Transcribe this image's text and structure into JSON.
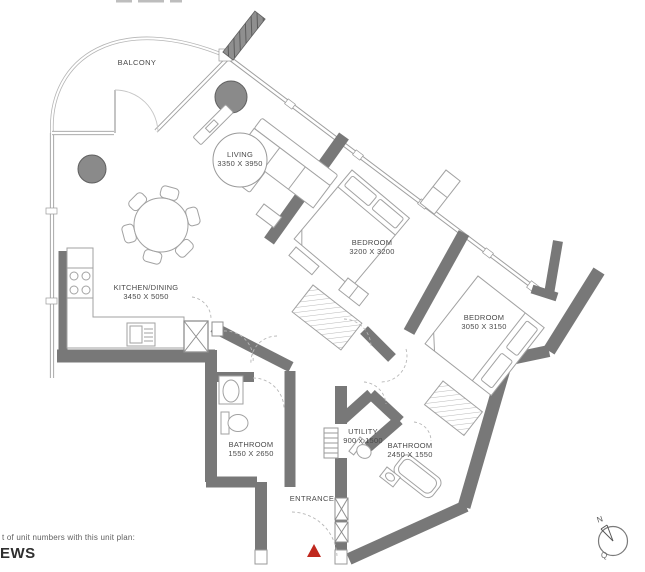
{
  "plan": {
    "rooms": {
      "balcony": {
        "label": "BALCONY"
      },
      "living": {
        "label": "LIVING",
        "dims": "3350 X 3950"
      },
      "kitchen_dining": {
        "label": "KITCHEN/DINING",
        "dims": "3450 X 5050"
      },
      "bedroom_1": {
        "label": "BEDROOM",
        "dims": "3200 X 3200"
      },
      "bedroom_2": {
        "label": "BEDROOM",
        "dims": "3050 X 3150"
      },
      "bathroom_1": {
        "label": "BATHROOM",
        "dims": "1550 X 2650"
      },
      "bathroom_2": {
        "label": "BATHROOM",
        "dims": "2450 X 1550"
      },
      "utility": {
        "label": "UTILITY",
        "dims": "900 x 1500"
      },
      "entrance": {
        "label": "ENTRANCE"
      }
    },
    "compass": {
      "north_label": "N",
      "tail_mark": "Q"
    },
    "colors": {
      "wall": "#787878",
      "glass_wall": "#9f9f9f",
      "furniture_line": "#a2a2a2",
      "entrance_marker": "#c0281e",
      "round_table_fill": "#8a8a8a",
      "label_text": "#4a4a4a"
    }
  },
  "footer": {
    "note": "t of unit numbers with this unit plan:",
    "cropped_word": "EWS"
  }
}
